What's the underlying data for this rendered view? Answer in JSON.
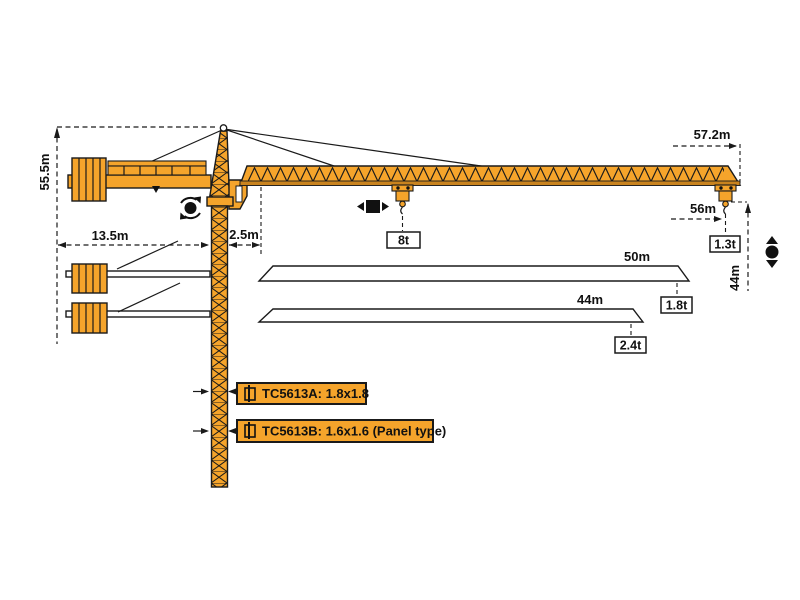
{
  "diagram": {
    "title": "TC5613 tower crane working range diagram",
    "models": {
      "a": "TC5613A: 1.8x1.8",
      "b": "TC5613B: 1.6x1.6 (Panel type)"
    },
    "dimensions": {
      "tower_height": "55.5m",
      "counter_jib_length": "13.5m",
      "jib_root_offset": "2.5m",
      "max_jib_length": "57.2m",
      "hook_radius": "56m",
      "tip_capacity": "1.3t",
      "hoist_height": "44m",
      "max_capacity": "8t",
      "jib_option_50": {
        "length": "50m",
        "tip_load": "1.8t"
      },
      "jib_option_44": {
        "length": "44m",
        "tip_load": "2.4t"
      }
    },
    "icons": {
      "slew_icon": "circular slewing arrows around dot",
      "trolley_travel_icon": "left-right arrows beside square",
      "hoist_icon": "up-down arrows with circle",
      "mast_section_icon": "square with vertical pin"
    },
    "colors": {
      "crane_orange": "#F5A42B",
      "chord_brown": "#C9831E",
      "line_black": "#1A1A1A",
      "value_box_white": "#FFFFFF"
    }
  }
}
